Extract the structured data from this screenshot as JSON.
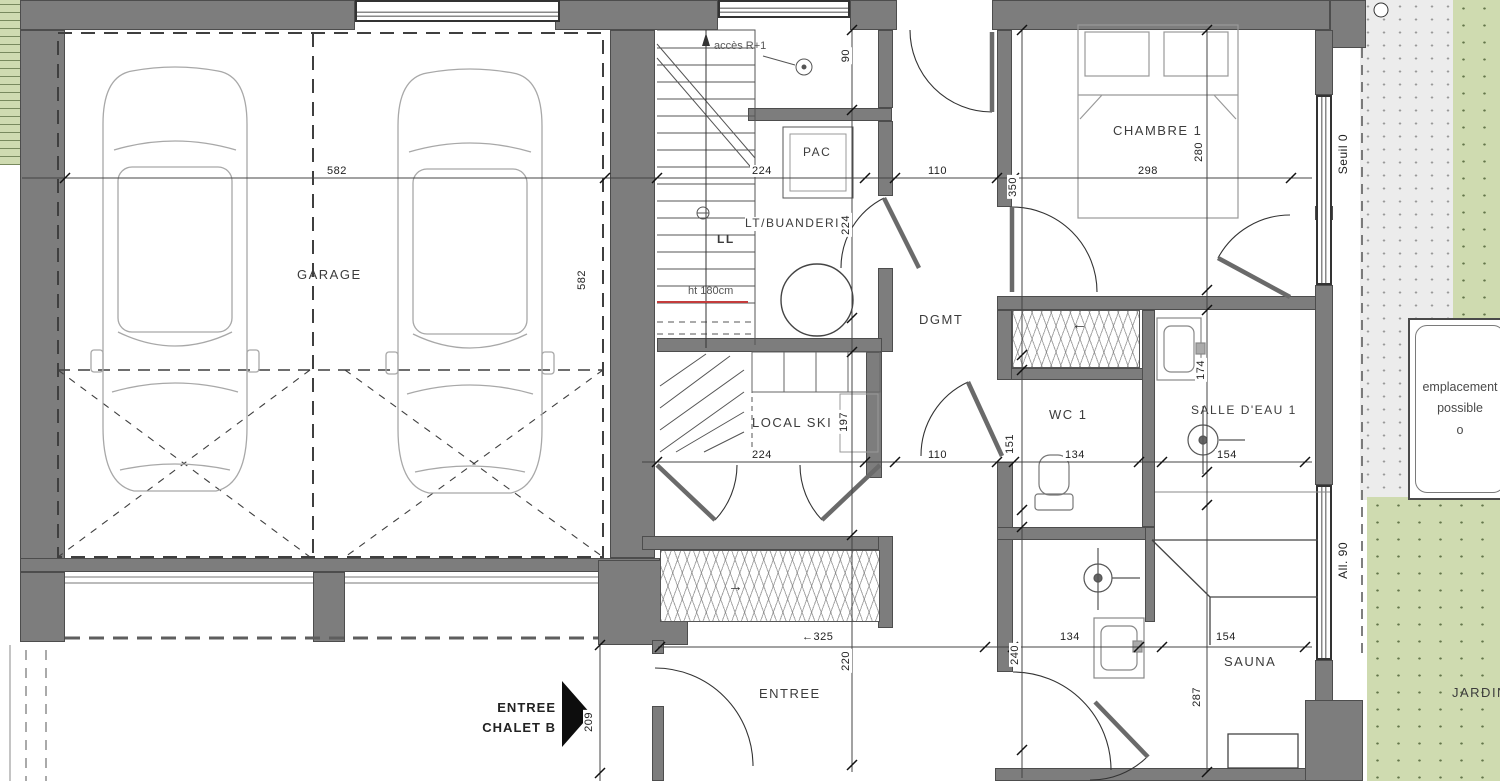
{
  "colors": {
    "wall": "#7d7d7d",
    "garden_green": "#cfdbb0",
    "terrace_gray": "#ececec",
    "note_red": "#c43c3c",
    "line": "#3c3c3c"
  },
  "rooms": {
    "garage": "GARAGE",
    "chambre": "CHAMBRE 1",
    "dgmt": "DGMT",
    "wc": "WC 1",
    "salle_deau": "SALLE D'EAU 1",
    "local_ski": "LOCAL SKI",
    "buanderie": "LT/BUANDERIE",
    "entree": "ENTREE",
    "sauna": "SAUNA",
    "jardin": "JARDIN"
  },
  "equipment": {
    "pac": "PAC",
    "ll": "LL",
    "acces": "accès R+1",
    "ht_note": "ht 180cm"
  },
  "annotations": {
    "seuil": "Seuil 0",
    "allee": "All. 90",
    "entree_chalet_1": "ENTREE",
    "entree_chalet_2": "CHALET B",
    "empl_1": "emplacement",
    "empl_2": "possible",
    "empl_3": "o",
    "closet_arrow_right": "→",
    "closet_arrow_left": "←"
  },
  "dims": {
    "garage_w": "582",
    "garage_h": "582",
    "top_224": "224",
    "top_110": "110",
    "chambre_w": "298",
    "chambre_h": "280",
    "left_350": "350",
    "v90": "90",
    "v224": "224",
    "v197": "197",
    "mid_224": "224",
    "mid_110": "110",
    "v151": "151",
    "mid_134": "134",
    "mid_154": "154",
    "v174": "174",
    "ent_325": "←325",
    "v220": "220",
    "v209": "209",
    "bot_134": "134",
    "v240": "240",
    "bot_154": "154",
    "v287": "287"
  }
}
